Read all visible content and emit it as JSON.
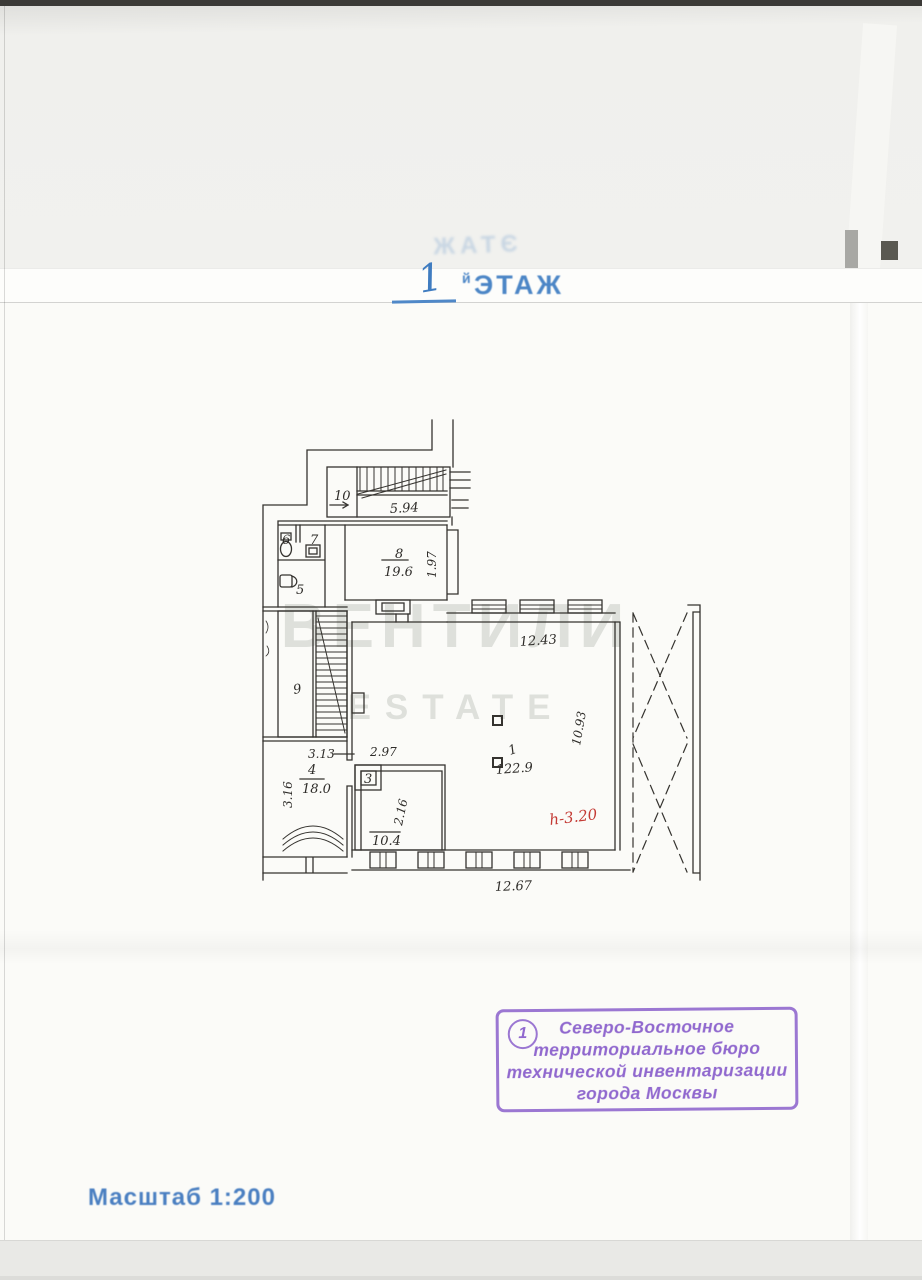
{
  "floor_stamp": {
    "ghost": "ЭТАЖ",
    "number": "1",
    "suffix": "й",
    "word": "ЭТАЖ"
  },
  "watermark": {
    "line1": "ВЕНТИЛИ",
    "line2": "ESTATE"
  },
  "plan": {
    "room10": "10",
    "dim594": "5.94",
    "room6": "6",
    "room7": "7",
    "room5": "5",
    "room8": "8",
    "area8": "19.6",
    "dim197": "1.97",
    "room9": "9",
    "dim313": "3.13",
    "dim297": "2.97",
    "room4": "4",
    "area4": "18.0",
    "dim316": "3.16",
    "room3": "3",
    "dim216": "2.16",
    "area104": "10.4",
    "room1": "1",
    "area1": "122.9",
    "height_note": "h-3.20",
    "dim1243": "12.43",
    "dim1093": "10.93",
    "dim1267": "12.67"
  },
  "bti_stamp": {
    "number": "1",
    "line1": "Северо-Восточное",
    "line2": "территориальное бюро",
    "line3": "технической инвентаризации",
    "line4": "города Москвы"
  },
  "scale_label": "Масштаб 1:200",
  "colors": {
    "stamp_purple": "#9068ce",
    "floor_blue": "#4c86c6",
    "scale_blue": "#4a7fc1",
    "plan_ink": "#35332f",
    "height_red": "#c43b35"
  }
}
